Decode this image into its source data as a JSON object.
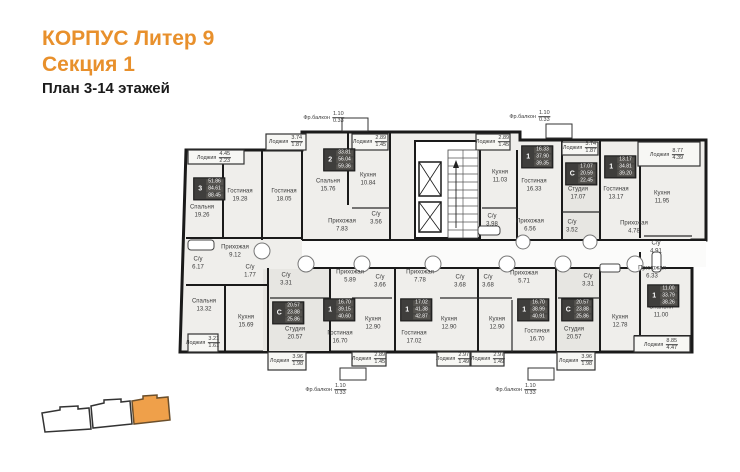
{
  "title": {
    "line1": "КОРПУС Литер 9",
    "line2": "Секция 1",
    "line3": "План 3-14 этажей"
  },
  "colors": {
    "accent": "#E8902C",
    "wall": "#1a1a1a",
    "apartment_fill": "#EFEEEB",
    "studio_fill": "#E7E6E2",
    "badge_bg": "#3f3e3c",
    "minimap_highlight": "#EFA04A"
  },
  "plan": {
    "rooms": [
      {
        "name": "Спальня",
        "area": "19.26",
        "x": 202,
        "y": 212
      },
      {
        "name": "Гостиная",
        "area": "19.28",
        "x": 240,
        "y": 196
      },
      {
        "name": "Гостиная",
        "area": "18.05",
        "x": 284,
        "y": 196
      },
      {
        "name": "Спальня",
        "area": "15.76",
        "x": 328,
        "y": 186
      },
      {
        "name": "Кухня",
        "area": "10.84",
        "x": 368,
        "y": 180
      },
      {
        "name": "Прихожая",
        "area": "7.83",
        "x": 342,
        "y": 226
      },
      {
        "name": "С/у",
        "area": "3.56",
        "x": 376,
        "y": 219
      },
      {
        "name": "Кухня",
        "area": "11.03",
        "x": 500,
        "y": 177
      },
      {
        "name": "Гостиная",
        "area": "16.33",
        "x": 534,
        "y": 186
      },
      {
        "name": "С/у",
        "area": "3.98",
        "x": 492,
        "y": 221
      },
      {
        "name": "Прихожая",
        "area": "6.56",
        "x": 530,
        "y": 226
      },
      {
        "name": "Студия",
        "area": "17.07",
        "x": 578,
        "y": 194
      },
      {
        "name": "С/у",
        "area": "3.52",
        "x": 572,
        "y": 227
      },
      {
        "name": "Гостиная",
        "area": "13.17",
        "x": 616,
        "y": 194
      },
      {
        "name": "Кухня",
        "area": "11.95",
        "x": 662,
        "y": 198
      },
      {
        "name": "Прихожая",
        "area": "4.78",
        "x": 634,
        "y": 228
      },
      {
        "name": "С/у",
        "area": "4.91",
        "x": 656,
        "y": 248
      },
      {
        "name": "Прихожая",
        "area": "9.12",
        "x": 235,
        "y": 252
      },
      {
        "name": "С/у",
        "area": "6.17",
        "x": 198,
        "y": 264
      },
      {
        "name": "С/у",
        "area": "1.77",
        "x": 250,
        "y": 272
      },
      {
        "name": "Спальня",
        "area": "13.32",
        "x": 204,
        "y": 306
      },
      {
        "name": "Кухня",
        "area": "15.69",
        "x": 246,
        "y": 322
      },
      {
        "name": "С/у",
        "area": "3.31",
        "x": 286,
        "y": 280
      },
      {
        "name": "Студия",
        "area": "20.57",
        "x": 295,
        "y": 334
      },
      {
        "name": "Прихожая",
        "area": "5.89",
        "x": 350,
        "y": 277
      },
      {
        "name": "С/у",
        "area": "3.66",
        "x": 380,
        "y": 282
      },
      {
        "name": "Гостиная",
        "area": "16.70",
        "x": 340,
        "y": 338
      },
      {
        "name": "Кухня",
        "area": "12.90",
        "x": 373,
        "y": 324
      },
      {
        "name": "Прихожая",
        "area": "7.78",
        "x": 420,
        "y": 277
      },
      {
        "name": "Гостиная",
        "area": "17.02",
        "x": 414,
        "y": 338
      },
      {
        "name": "С/у",
        "area": "3.68",
        "x": 460,
        "y": 282
      },
      {
        "name": "Кухня",
        "area": "12.90",
        "x": 449,
        "y": 324
      },
      {
        "name": "С/у",
        "area": "3.68",
        "x": 488,
        "y": 282
      },
      {
        "name": "Кухня",
        "area": "12.90",
        "x": 497,
        "y": 324
      },
      {
        "name": "Прихожая",
        "area": "5.71",
        "x": 524,
        "y": 278
      },
      {
        "name": "Гостиная",
        "area": "16.70",
        "x": 537,
        "y": 336
      },
      {
        "name": "С/у",
        "area": "3.31",
        "x": 588,
        "y": 281
      },
      {
        "name": "Студия",
        "area": "20.57",
        "x": 574,
        "y": 334
      },
      {
        "name": "Кухня",
        "area": "12.78",
        "x": 620,
        "y": 322
      },
      {
        "name": "Прихожая",
        "area": "6.33",
        "x": 652,
        "y": 273
      },
      {
        "name": "Спальня",
        "area": "11.00",
        "x": 661,
        "y": 312
      }
    ],
    "loggias": [
      {
        "name": "Лоджия",
        "full": "4.45",
        "counted": "2.23",
        "x": 214,
        "y": 158
      },
      {
        "name": "Лоджия",
        "full": "3.74",
        "counted": "1.87",
        "x": 286,
        "y": 142
      },
      {
        "name": "Фр.балкон",
        "full": "1.10",
        "counted": "0.33",
        "x": 324,
        "y": 118
      },
      {
        "name": "Лоджия",
        "full": "2.89",
        "counted": "1.45",
        "x": 370,
        "y": 142
      },
      {
        "name": "Лоджия",
        "full": "2.89",
        "counted": "1.45",
        "x": 493,
        "y": 142
      },
      {
        "name": "Фр.балкон",
        "full": "1.10",
        "counted": "0.33",
        "x": 530,
        "y": 117
      },
      {
        "name": "Лоджия",
        "full": "3.74",
        "counted": "1.87",
        "x": 580,
        "y": 148
      },
      {
        "name": "Лоджия",
        "full": "8.77",
        "counted": "4.39",
        "x": 667,
        "y": 155
      },
      {
        "name": "Лоджия",
        "full": "3.21",
        "counted": "1.61",
        "x": 203,
        "y": 343
      },
      {
        "name": "Лоджия",
        "full": "3.96",
        "counted": "1.98",
        "x": 287,
        "y": 361
      },
      {
        "name": "Лоджия",
        "full": "2.89",
        "counted": "1.45",
        "x": 369,
        "y": 359
      },
      {
        "name": "Лоджия",
        "full": "2.97",
        "counted": "1.49",
        "x": 453,
        "y": 359
      },
      {
        "name": "Лоджия",
        "full": "2.97",
        "counted": "1.49",
        "x": 488,
        "y": 359
      },
      {
        "name": "Лоджия",
        "full": "3.96",
        "counted": "1.98",
        "x": 576,
        "y": 361
      },
      {
        "name": "Фр.балкон",
        "full": "1.10",
        "counted": "0.33",
        "x": 326,
        "y": 390
      },
      {
        "name": "Фр.балкон",
        "full": "1.10",
        "counted": "0.33",
        "x": 516,
        "y": 390
      },
      {
        "name": "Лоджия",
        "full": "8.85",
        "counted": "4.47",
        "x": 661,
        "y": 345
      }
    ],
    "badges": [
      {
        "type": "3",
        "values": [
          "51.86",
          "84.61",
          "88.45"
        ],
        "x": 209,
        "y": 189
      },
      {
        "type": "2",
        "values": [
          "33.81",
          "56.04",
          "59.36"
        ],
        "x": 339,
        "y": 160
      },
      {
        "type": "1",
        "values": [
          "16.33",
          "37.90",
          "39.35"
        ],
        "x": 537,
        "y": 157
      },
      {
        "type": "С",
        "values": [
          "17.07",
          "20.59",
          "22.45"
        ],
        "x": 581,
        "y": 174
      },
      {
        "type": "1",
        "values": [
          "13.17",
          "34.81",
          "39.20"
        ],
        "x": 620,
        "y": 167
      },
      {
        "type": "С",
        "values": [
          "20.57",
          "23.88",
          "25.86"
        ],
        "x": 288,
        "y": 313
      },
      {
        "type": "1",
        "values": [
          "16.70",
          "39.15",
          "40.60"
        ],
        "x": 339,
        "y": 310
      },
      {
        "type": "1",
        "values": [
          "17.02",
          "41.38",
          "42.87"
        ],
        "x": 416,
        "y": 310
      },
      {
        "type": "1",
        "values": [
          "16.70",
          "38.99",
          "40.91"
        ],
        "x": 533,
        "y": 310
      },
      {
        "type": "С",
        "values": [
          "20.57",
          "23.88",
          "25.86"
        ],
        "x": 577,
        "y": 310
      },
      {
        "type": "1",
        "values": [
          "11.00",
          "33.79",
          "38.26"
        ],
        "x": 663,
        "y": 296
      }
    ]
  }
}
